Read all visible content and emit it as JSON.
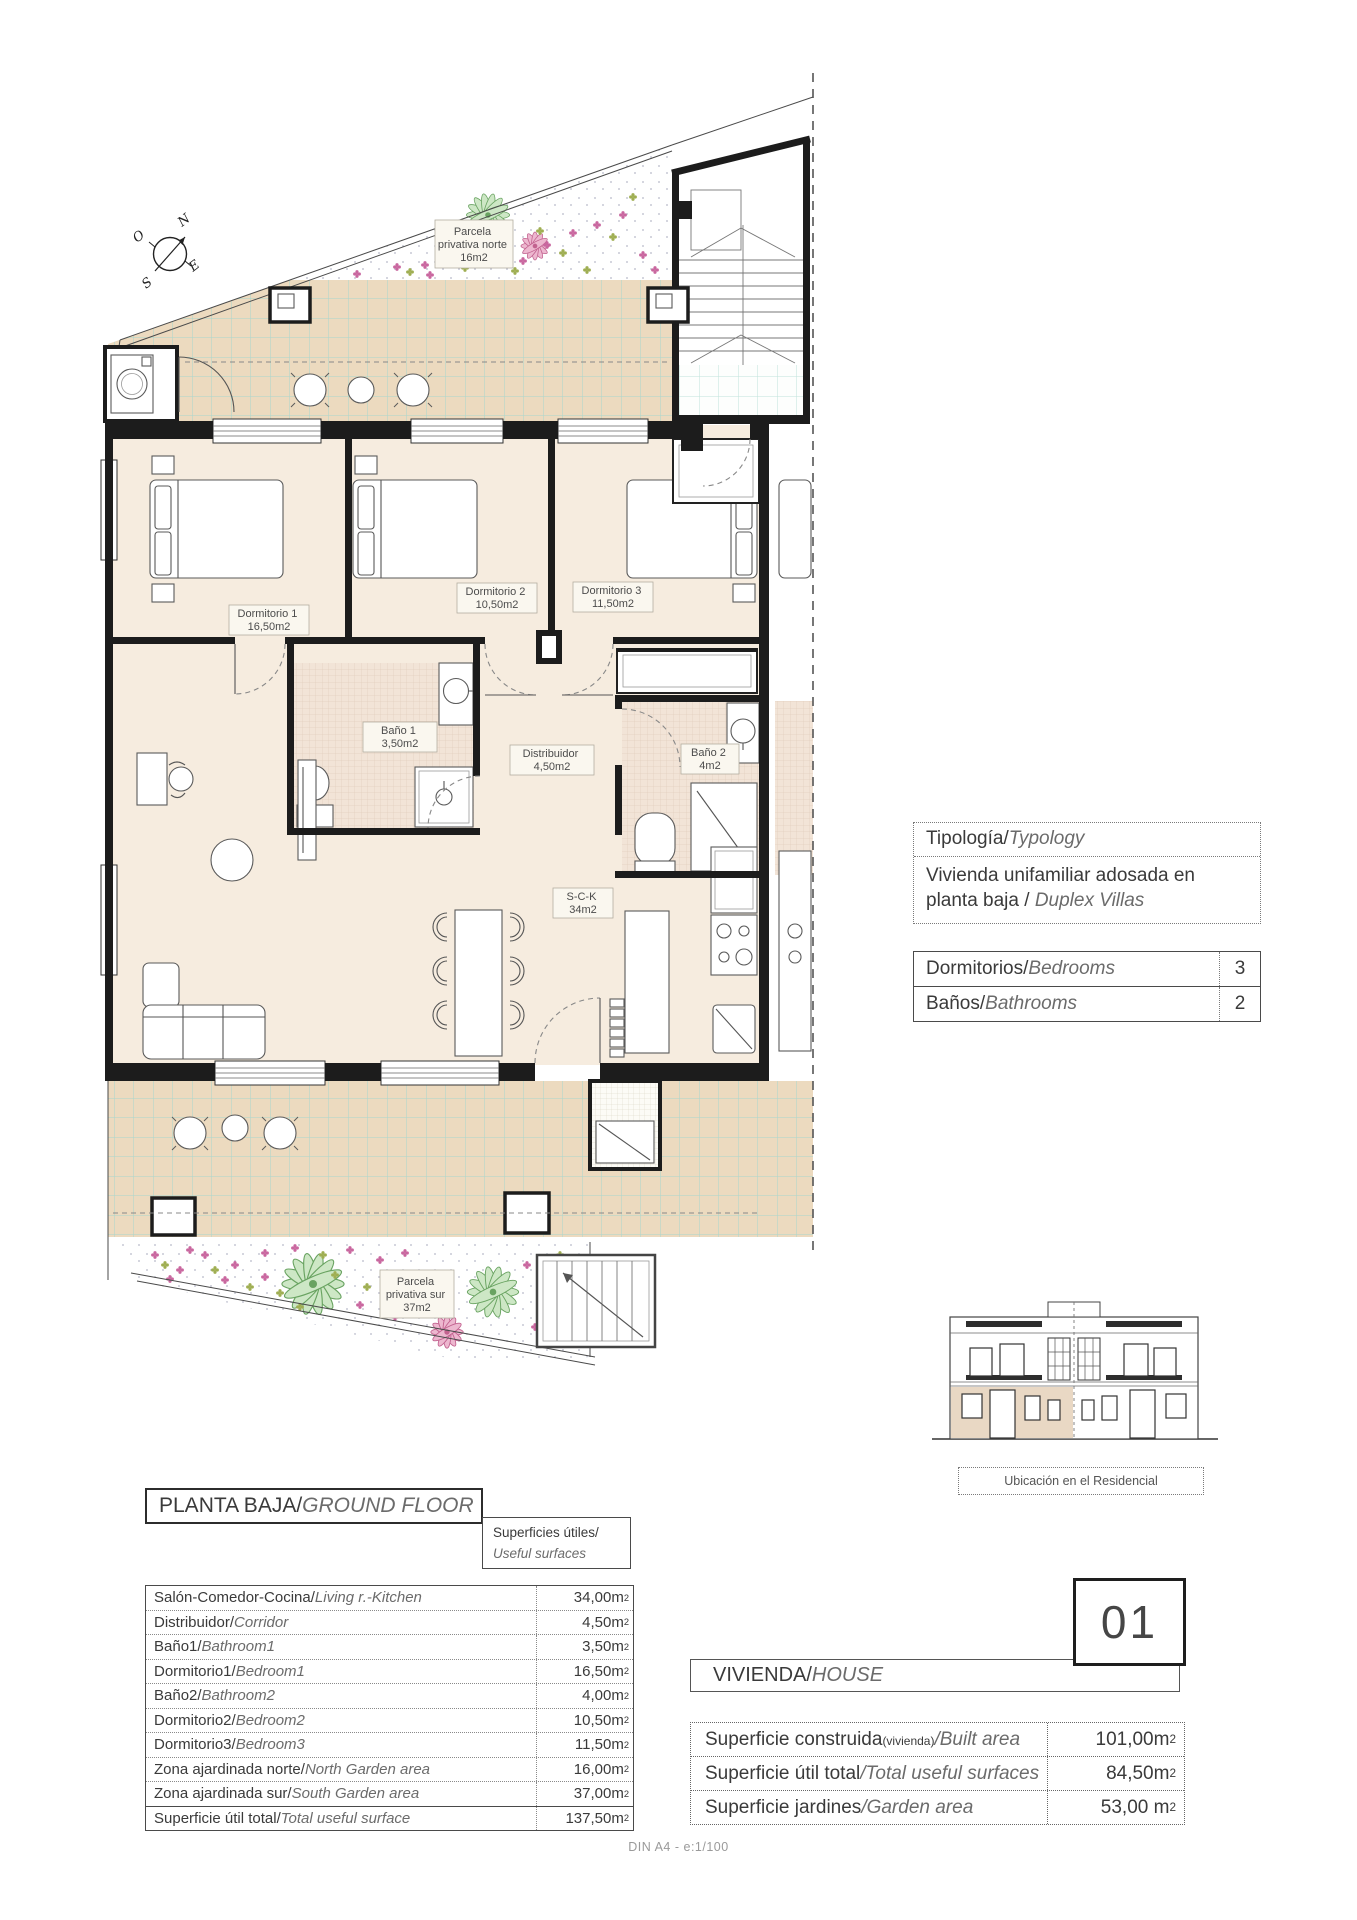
{
  "compass": {
    "n": "N",
    "o": "O",
    "e": "E",
    "s": "S"
  },
  "plan": {
    "parcela_norte": {
      "l1": "Parcela",
      "l2": "privativa norte",
      "l3": "16m2"
    },
    "parcela_sur": {
      "l1": "Parcela",
      "l2": "privativa sur",
      "l3": "37m2"
    },
    "dorm1": {
      "name": "Dormitorio 1",
      "area": "16,50m2"
    },
    "dorm2": {
      "name": "Dormitorio 2",
      "area": "10,50m2"
    },
    "dorm3": {
      "name": "Dormitorio 3",
      "area": "11,50m2"
    },
    "bano1": {
      "name": "Baño 1",
      "area": "3,50m2"
    },
    "bano2": {
      "name": "Baño 2",
      "area": "4m2"
    },
    "distribuidor": {
      "name": "Distribuidor",
      "area": "4,50m2"
    },
    "sck": {
      "name": "S-C-K",
      "area": "34m2"
    }
  },
  "typology": {
    "title_es": "Tipología/",
    "title_en": "Typology",
    "desc_es": "Vivienda unifamiliar adosada en planta baja / ",
    "desc_en": "Duplex Villas",
    "rows": [
      {
        "es": "Dormitorios/",
        "en": "Bedrooms",
        "value": "3"
      },
      {
        "es": "Baños/",
        "en": "Bathrooms",
        "value": "2"
      }
    ]
  },
  "location_caption": "Ubicación en el Residencial",
  "ground_floor": {
    "title_es": "PLANTA BAJA/",
    "title_en": "GROUND FLOOR",
    "surfaces_es": "Superficies útiles/",
    "surfaces_en": "Useful surfaces",
    "rows": [
      {
        "es": "Salón-Comedor-Cocina/",
        "en": "Living r.-Kitchen",
        "value": "34,00m",
        "sup": "2"
      },
      {
        "es": "Distribuidor/",
        "en": "Corridor",
        "value": "4,50m",
        "sup": "2"
      },
      {
        "es": "Baño1/",
        "en": "Bathroom1",
        "value": "3,50m",
        "sup": "2"
      },
      {
        "es": "Dormitorio1/",
        "en": "Bedroom1",
        "value": "16,50m",
        "sup": "2"
      },
      {
        "es": "Baño2/",
        "en": "Bathroom2",
        "value": "4,00m",
        "sup": "2"
      },
      {
        "es": "Dormitorio2/",
        "en": "Bedroom2",
        "value": "10,50m",
        "sup": "2"
      },
      {
        "es": "Dormitorio3/",
        "en": "Bedroom3",
        "value": "11,50m",
        "sup": "2"
      },
      {
        "es": "Zona ajardinada norte/",
        "en": "North Garden area",
        "value": "16,00m",
        "sup": "2"
      },
      {
        "es": "Zona ajardinada sur/",
        "en": "South Garden area",
        "value": "37,00m",
        "sup": "2"
      },
      {
        "es": "Superficie útil total/",
        "en": "Total useful surface",
        "value": "137,50m",
        "sup": "2"
      }
    ]
  },
  "house": {
    "number": "01",
    "title_es": "VIVIENDA/",
    "title_en": "HOUSE",
    "rows": [
      {
        "es": "Superficie construida",
        "small": "(vivienda)",
        "en": "/Built area",
        "value": "101,00m",
        "sup": "2"
      },
      {
        "es": "Superficie útil total",
        "small": "",
        "en": "/Total useful surfaces",
        "value": "84,50m",
        "sup": "2"
      },
      {
        "es": "Superficie jardines",
        "small": "",
        "en": "/Garden area",
        "value": "53,00 m",
        "sup": "2"
      }
    ]
  },
  "footer": "DIN A4 - e:1/100"
}
